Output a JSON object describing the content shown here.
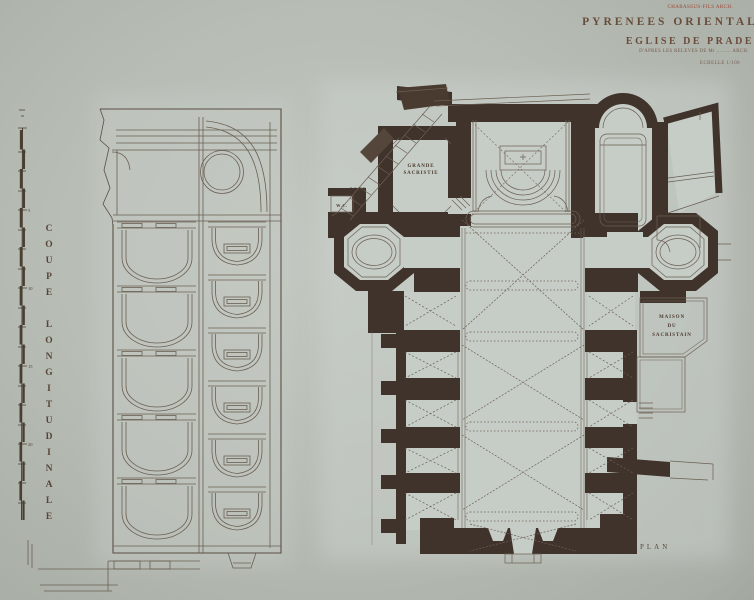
{
  "sheet": {
    "stamp_text": "CHABASSUS-FILS ARCH.",
    "header": {
      "region": "PYRENEES ORIENTALES",
      "title": "EGLISE DE PRADES",
      "subtitle": "D'APRES LES RELEVES DE Mr ......... ARCH.",
      "scale": "ECHELLE 1/100"
    }
  },
  "section": {
    "caption": "COUPE LONGITUDINALE",
    "scalebar_ticks": [
      "5",
      "10",
      "15",
      "20"
    ]
  },
  "plan": {
    "caption": "PLAN",
    "labels": {
      "grande_sacristie_l1": "GRANDE",
      "grande_sacristie_l2": "SACRISTIE",
      "cour": "COUR",
      "wc": "W.C.",
      "maison_l1": "MAISON",
      "maison_l2": "DU",
      "maison_l3": "SACRISTAIN"
    }
  },
  "colors": {
    "paper": "#b7bdb5",
    "room_fill": "#c6ccc6",
    "wall_poche": "#40332b",
    "ink_line": "#6b5f53",
    "title_ink": "#6a4c3b",
    "stamp_red": "#9c4531"
  }
}
